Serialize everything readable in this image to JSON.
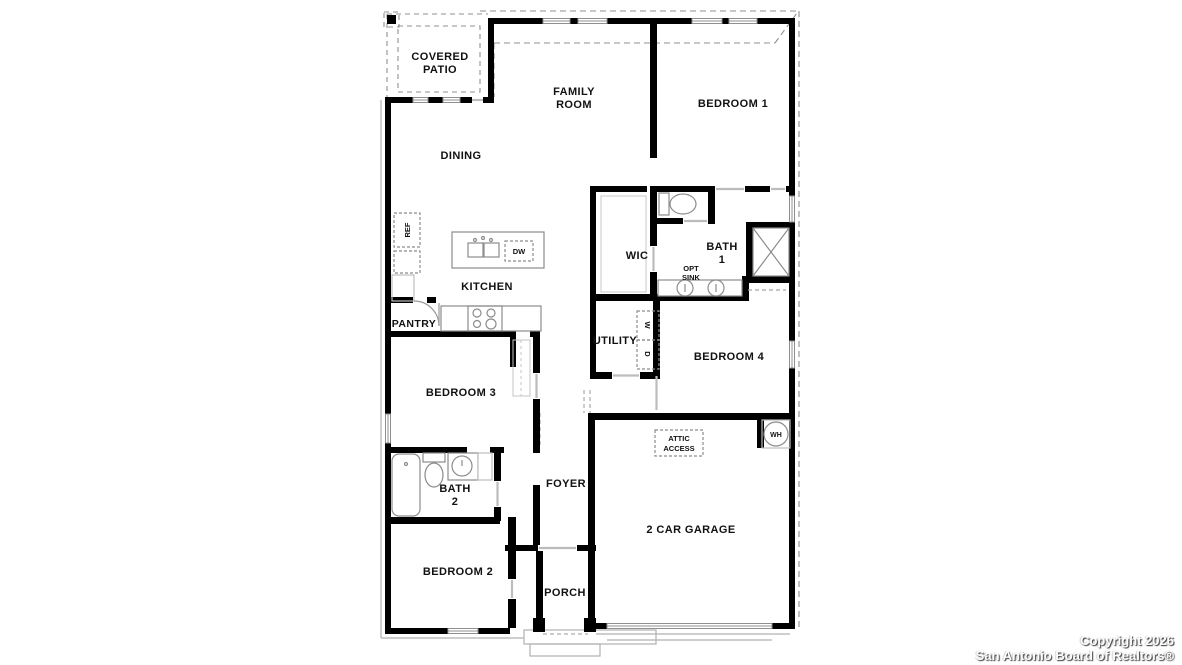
{
  "labels": {
    "covered_patio_line1": "COVERED",
    "covered_patio_line2": "PATIO",
    "family_room_line1": "FAMILY",
    "family_room_line2": "ROOM",
    "bedroom1": "BEDROOM 1",
    "dining": "DINING",
    "ref": "REF",
    "dw": "DW",
    "kitchen": "KITCHEN",
    "pantry": "PANTRY",
    "wic": "WIC",
    "bath1_line1": "BATH",
    "bath1_line2": "1",
    "opt_sink_line1": "OPT",
    "opt_sink_line2": "SINK",
    "utility": "UTILITY",
    "washer": "W",
    "dryer": "D",
    "bedroom3": "BEDROOM 3",
    "bedroom4": "BEDROOM 4",
    "attic_line1": "ATTIC",
    "attic_line2": "ACCESS",
    "wh": "WH",
    "bath2_line1": "BATH",
    "bath2_line2": "2",
    "foyer": "FOYER",
    "garage": "2 CAR GARAGE",
    "bedroom2": "BEDROOM 2",
    "porch": "PORCH"
  },
  "footer": {
    "line1": "Copyright 2026",
    "line2": "San Antonio Board of Realtors®"
  },
  "colors": {
    "wall": "#000000",
    "fixture_gray": "#8c8c8c",
    "dash_gray": "#909090",
    "door_gray": "#b8b8b8"
  }
}
